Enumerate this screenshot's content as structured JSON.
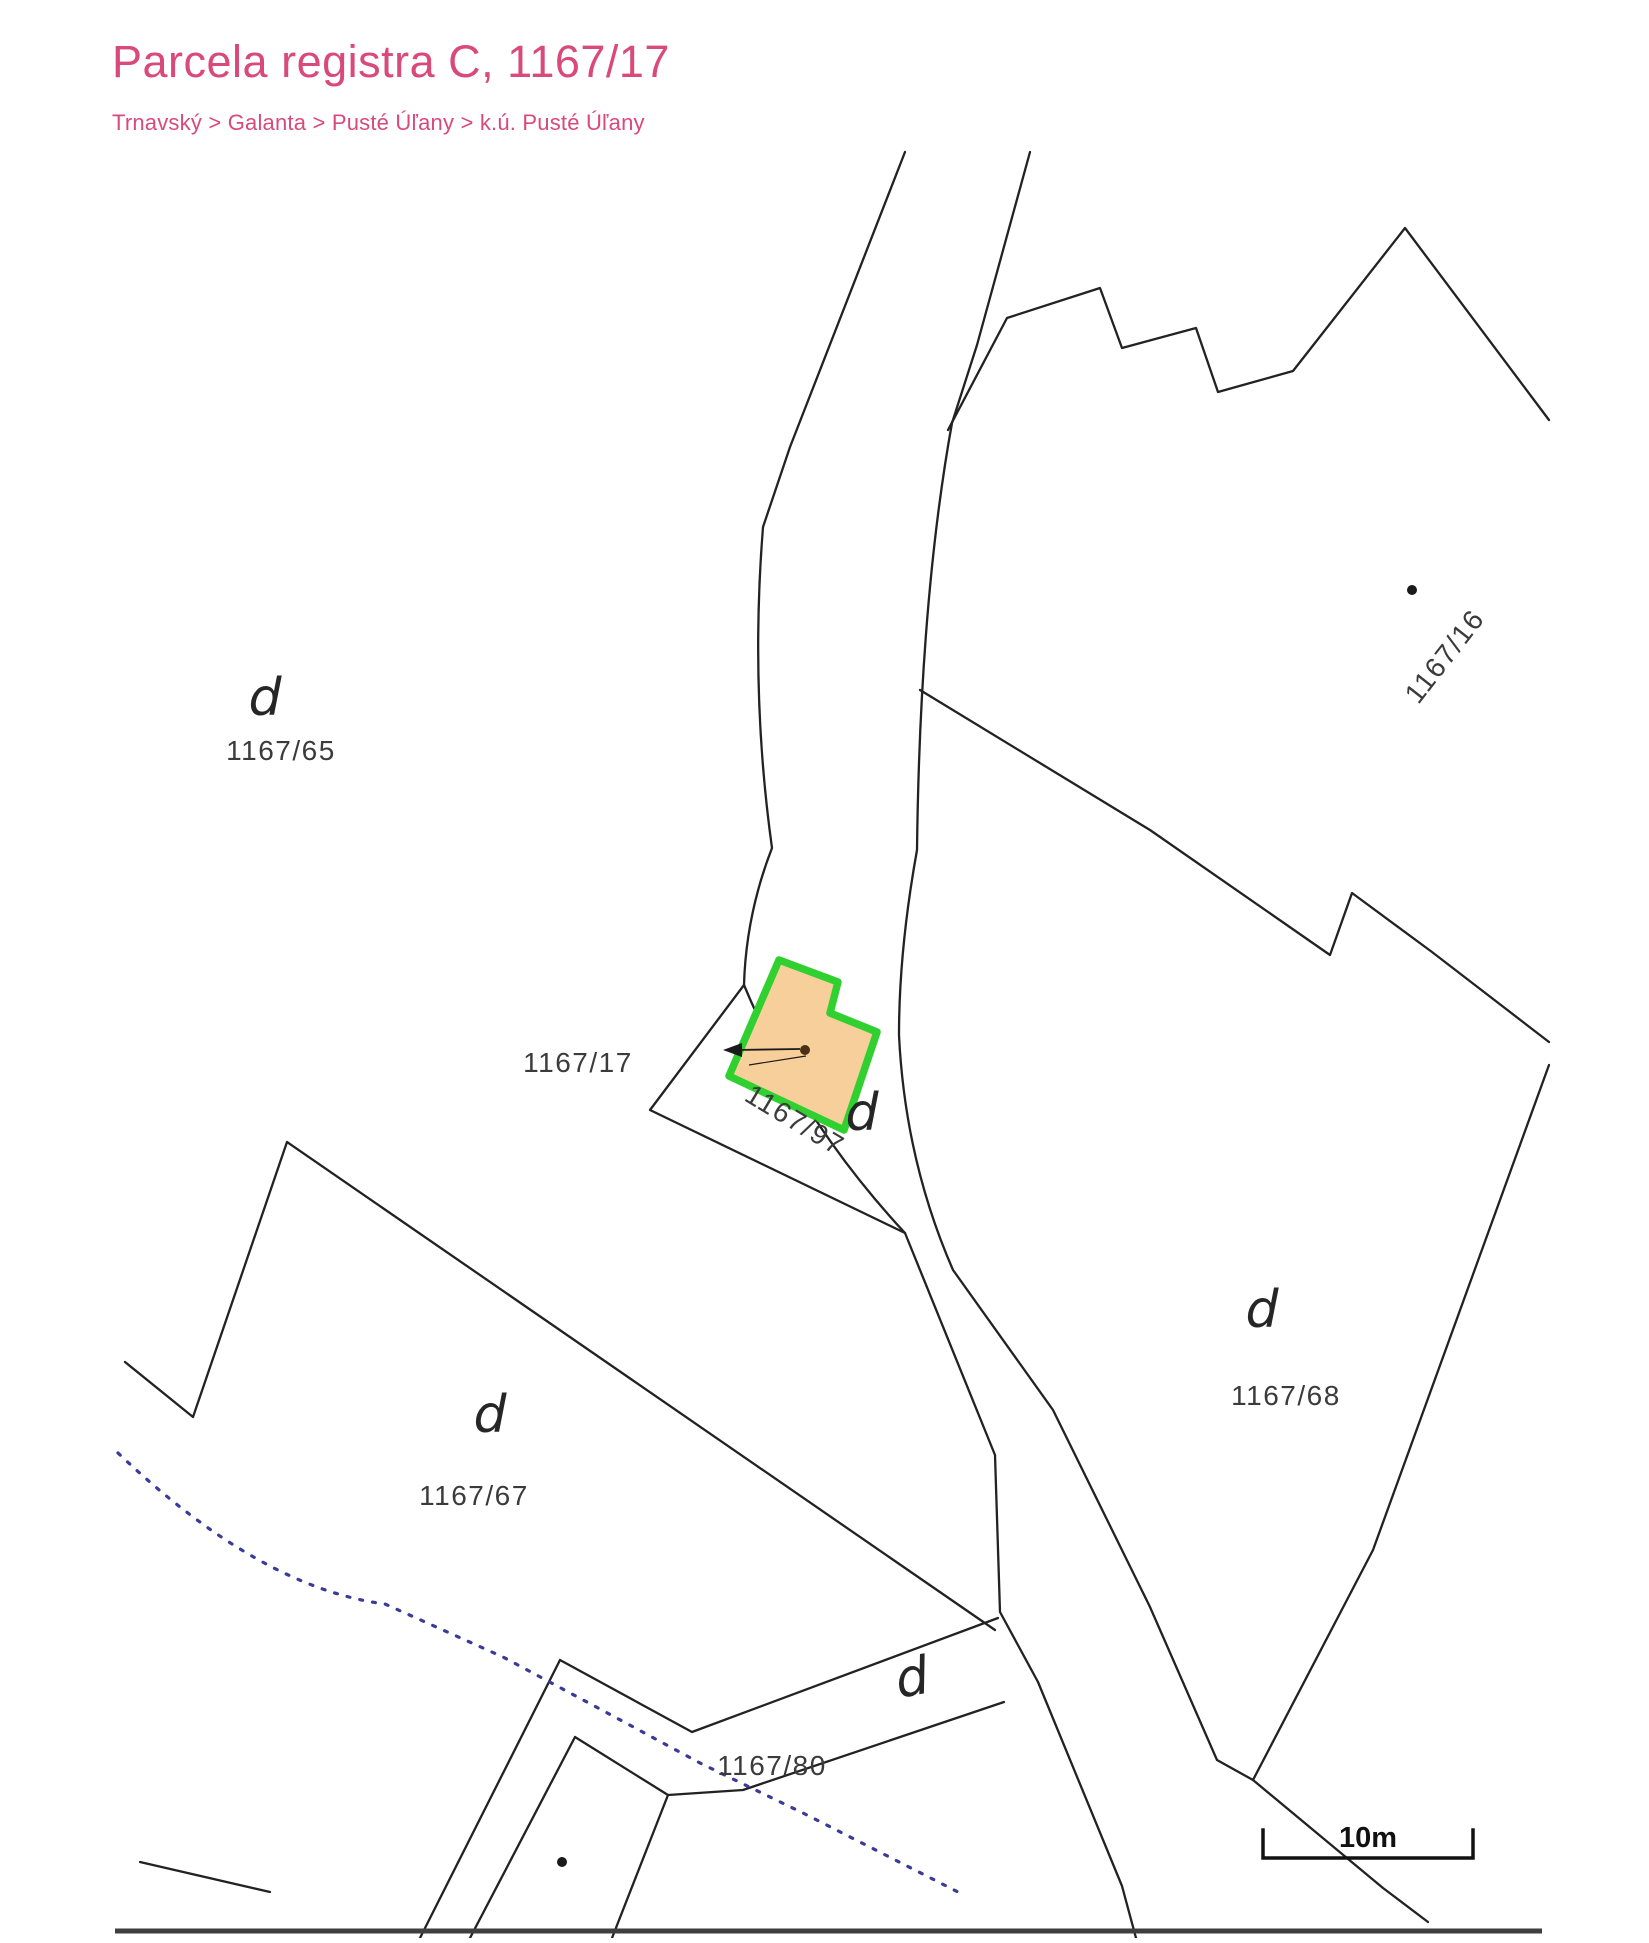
{
  "header": {
    "title": "Parcela registra C, 1167/17",
    "breadcrumb": "Trnavský > Galanta > Pusté Úľany > k.ú. Pusté Úľany"
  },
  "colors": {
    "accent": "#d9497a",
    "boundary_line": "#222222",
    "label_text": "#3b3b3b",
    "highlight_fill": "#f7cf9a",
    "highlight_stroke": "#2fd02f",
    "dotted_line": "#3a3a99",
    "bottom_bar": "#3f3f3f"
  },
  "map": {
    "parcel_labels": [
      {
        "text": "1167/65",
        "x": 281,
        "y": 760,
        "rotate": 0
      },
      {
        "text": "1167/17",
        "x": 578,
        "y": 1072,
        "rotate": 0
      },
      {
        "text": "1167/97",
        "x": 790,
        "y": 1128,
        "rotate": 31
      },
      {
        "text": "1167/16",
        "x": 1452,
        "y": 662,
        "rotate": -52
      },
      {
        "text": "1167/68",
        "x": 1286,
        "y": 1405,
        "rotate": 0
      },
      {
        "text": "1167/67",
        "x": 474,
        "y": 1505,
        "rotate": 0
      },
      {
        "text": "1167/80",
        "x": 772,
        "y": 1775,
        "rotate": 0
      }
    ],
    "building_letters": [
      {
        "text": "d",
        "x": 265,
        "y": 715,
        "rotate": 0
      },
      {
        "text": "d",
        "x": 862,
        "y": 1130,
        "rotate": 0
      },
      {
        "text": "d",
        "x": 490,
        "y": 1432,
        "rotate": 0
      },
      {
        "text": "d",
        "x": 1262,
        "y": 1327,
        "rotate": 0
      },
      {
        "text": "d",
        "x": 915,
        "y": 1695,
        "rotate": -10
      }
    ],
    "dots": [
      {
        "x": 1412,
        "y": 590,
        "r": 5,
        "color": "#1a1a1a"
      },
      {
        "x": 805,
        "y": 1050,
        "r": 5,
        "color": "#4a3014"
      },
      {
        "x": 562,
        "y": 1862,
        "r": 5,
        "color": "#1a1a1a"
      }
    ],
    "highlighted_parcel": {
      "number": "1167/97"
    },
    "scale_bar": {
      "label": "10m"
    }
  }
}
